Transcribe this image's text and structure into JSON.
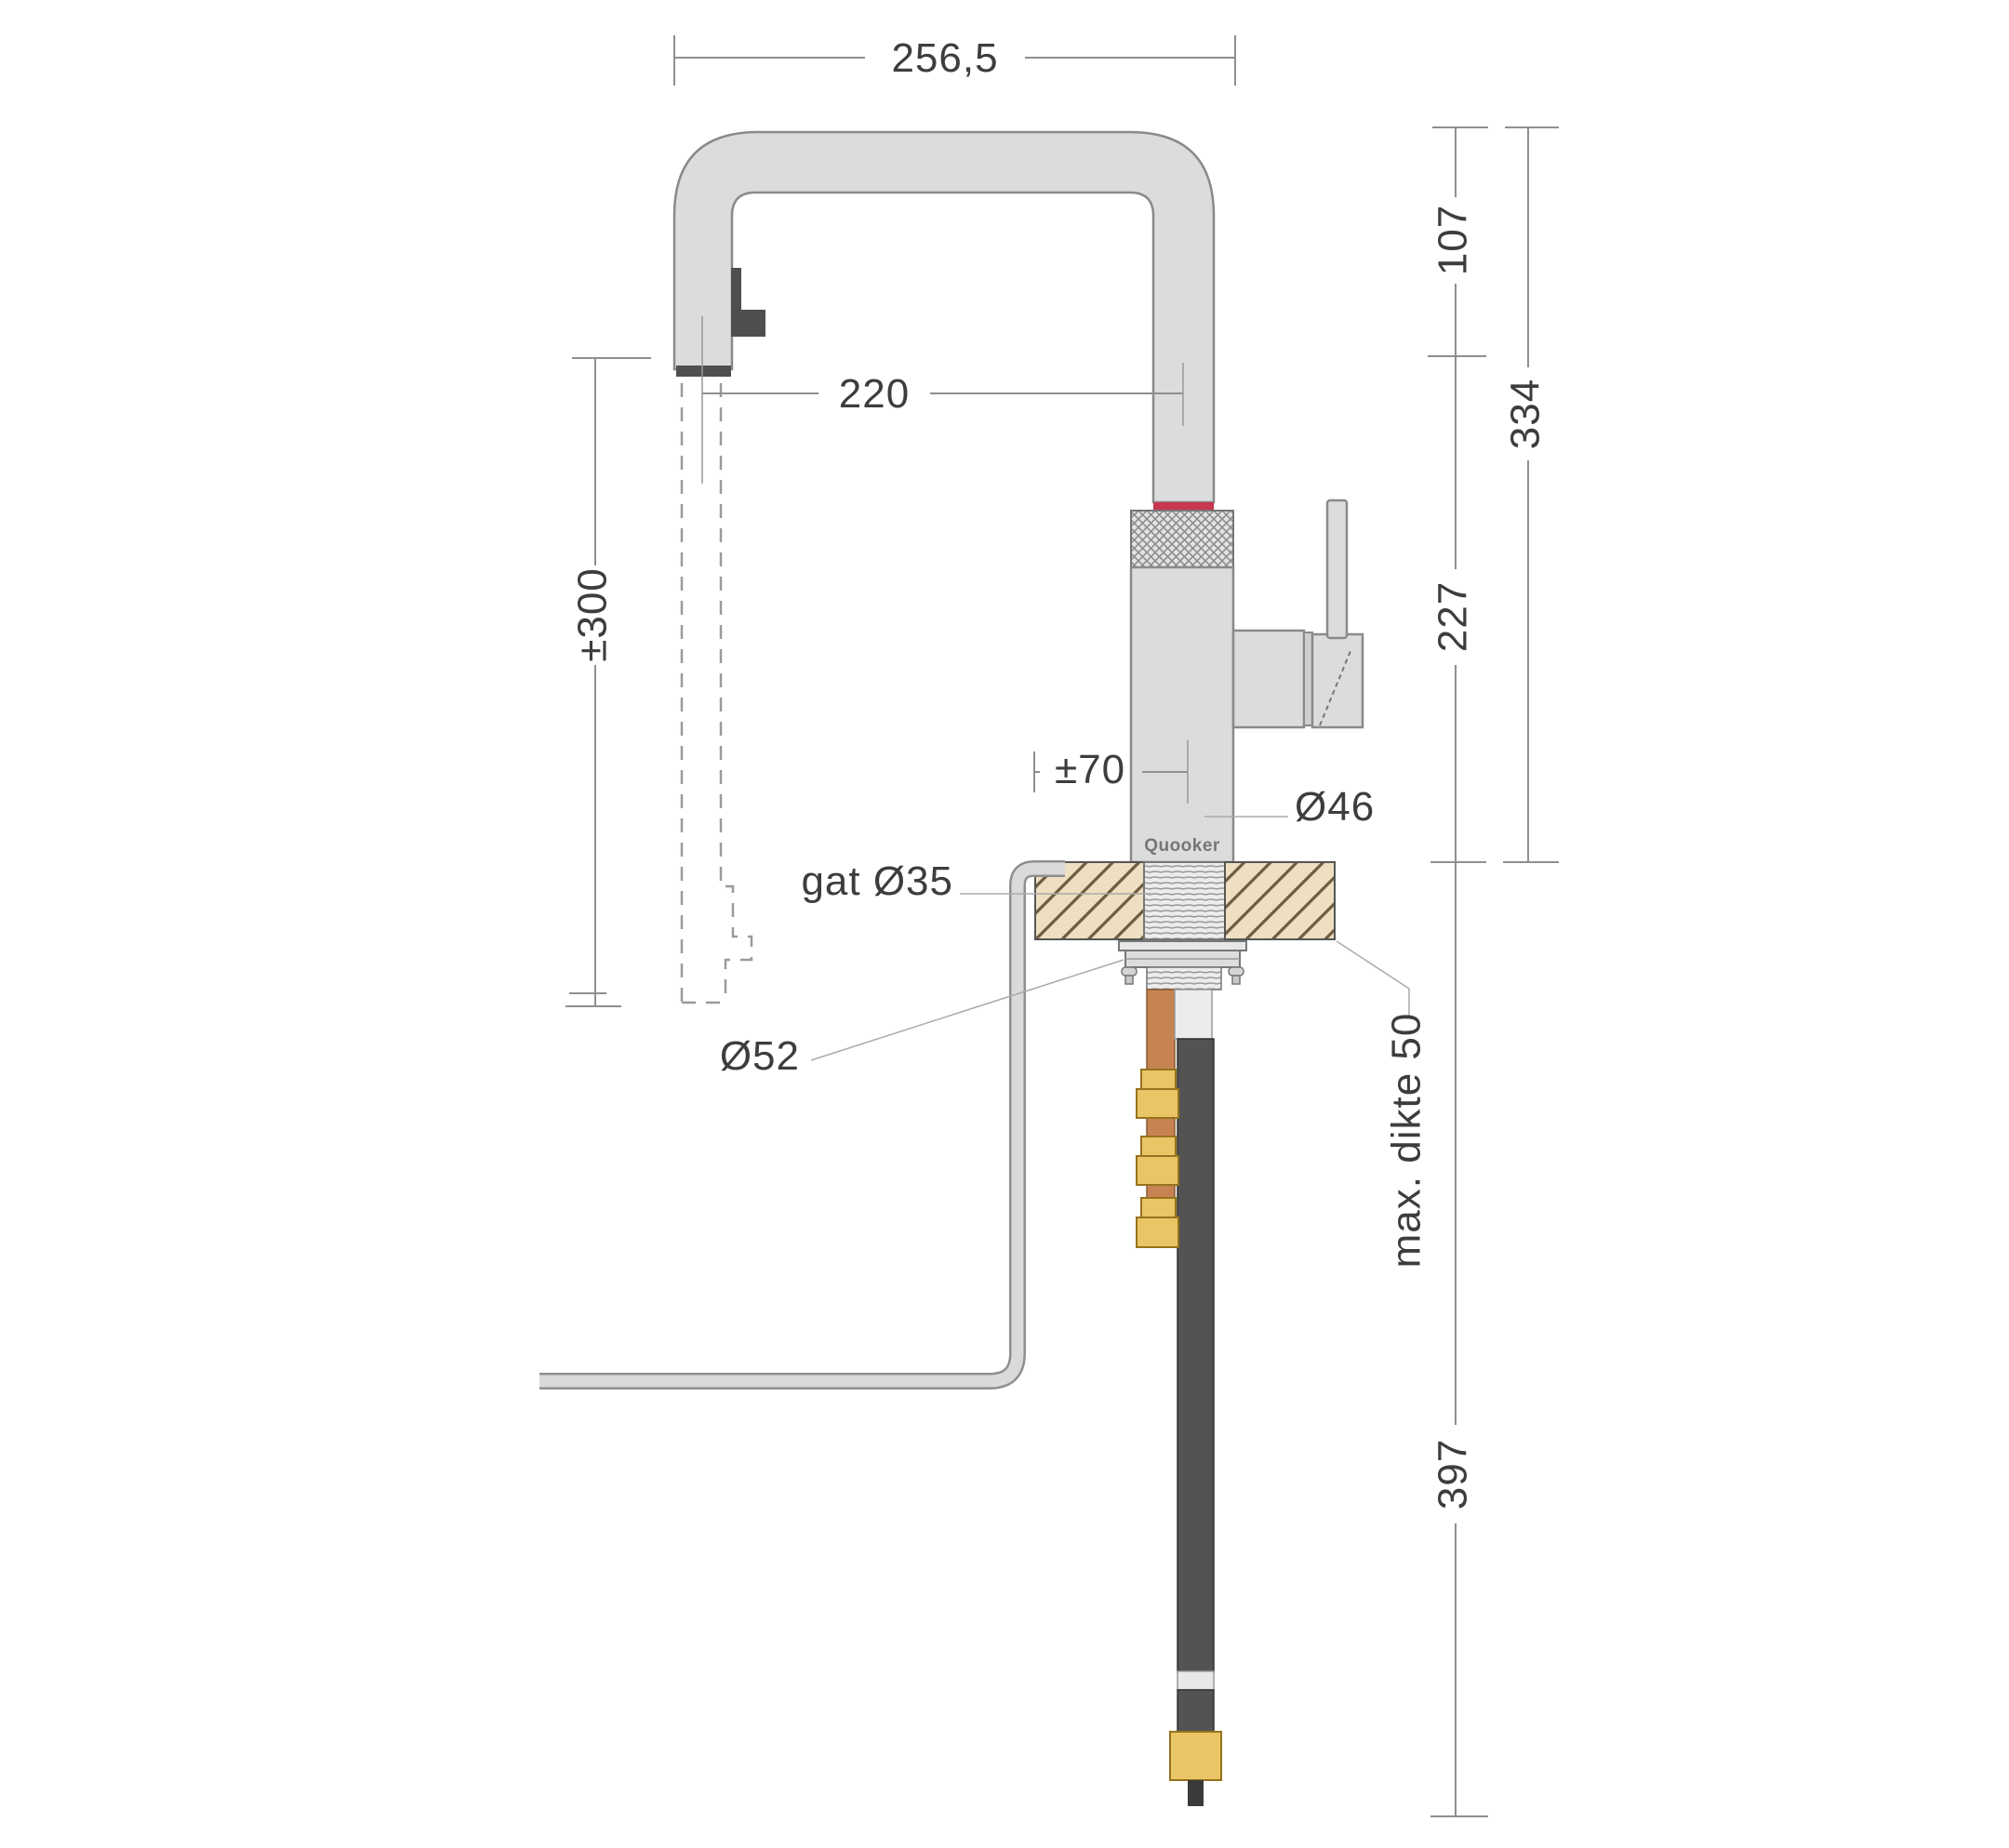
{
  "drawing": {
    "brand_label": "Quooker",
    "dimensions": {
      "spout_reach": "256,5",
      "spout_rise": "107",
      "height_above_counter": "334",
      "spout_horizontal_reach": "220",
      "body_height": "227",
      "stream_length": "±300",
      "center_offset": "±70",
      "body_diameter": "Ø46",
      "hole_diameter": "gat Ø35",
      "flange_diameter": "Ø52",
      "max_counter_thickness": "max. dikte 50",
      "below_counter_depth": "397"
    },
    "colors": {
      "accent_red": "#c8374f",
      "metal_gray": "#dcdcdc",
      "counter_beige": "#eedfc0",
      "brass": "#e9c566",
      "copper": "#c78352",
      "hose_black": "#535353"
    }
  }
}
